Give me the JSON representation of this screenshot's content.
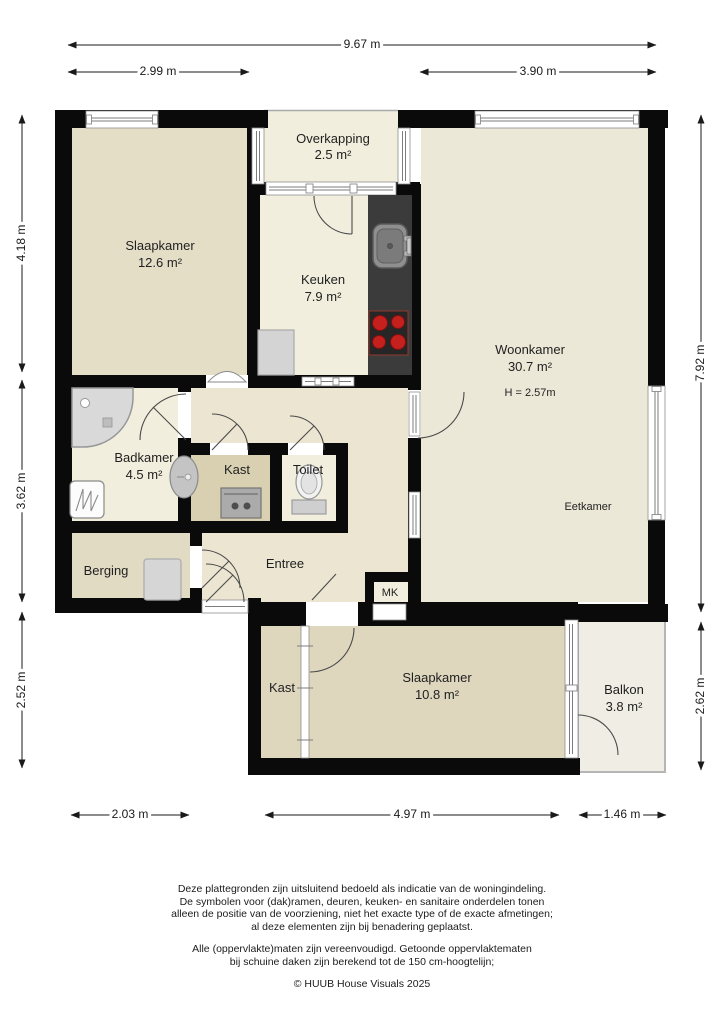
{
  "rooms": {
    "slaapkamer_tl": {
      "name": "Slaapkamer",
      "area": "12.6 m²"
    },
    "overkapping": {
      "name": "Overkapping",
      "area": "2.5 m²"
    },
    "keuken": {
      "name": "Keuken",
      "area": "7.9 m²"
    },
    "woonkamer": {
      "name": "Woonkamer",
      "area": "30.7 m²",
      "height": "H = 2.57m"
    },
    "eetkamer": {
      "name": "Eetkamer"
    },
    "badkamer": {
      "name": "Badkamer",
      "area": "4.5 m²"
    },
    "kast": {
      "name": "Kast"
    },
    "toilet": {
      "name": "Toilet"
    },
    "berging": {
      "name": "Berging"
    },
    "entree": {
      "name": "Entree"
    },
    "mk": {
      "name": "MK"
    },
    "kast_bottom": {
      "name": "Kast"
    },
    "slaapkamer_bottom": {
      "name": "Slaapkamer",
      "area": "10.8 m²"
    },
    "balkon": {
      "name": "Balkon",
      "area": "3.8 m²"
    }
  },
  "dimensions": {
    "top_total": "9.67 m",
    "top_left": "2.99 m",
    "top_right": "3.90 m",
    "left_top": "4.18 m",
    "left_middle": "3.62 m",
    "left_bottom": "2.52 m",
    "right_top": "7.92 m",
    "right_bottom": "2.62 m",
    "bottom_left": "2.03 m",
    "bottom_middle": "4.97 m",
    "bottom_right": "1.46 m"
  },
  "footer": {
    "disclaimer_lines": [
      "Deze plattegronden zijn uitsluitend bedoeld als indicatie van de woningindeling.",
      "De symbolen voor (dak)ramen, deuren, keuken- en sanitaire onderdelen tonen",
      "alleen de positie van de voorziening, niet het exacte type of de exacte afmetingen;",
      "al deze elementen zijn bij benadering geplaatst."
    ],
    "note_lines": [
      "Alle (oppervlakte)maten zijn vereenvoudigd. Getoonde oppervlaktematen",
      "bij schuine daken zijn berekend tot de 150 cm-hoogtelijn;"
    ],
    "copyright": "© HUUB House Visuals 2025"
  },
  "colors": {
    "wall": "#0a0a0a",
    "room_light": "#f1eedd",
    "room_mid": "#ece8d8",
    "room_tan_dark": "#ded7be",
    "room_tan": "#e4dec7",
    "kast_fill": "#d8d0b1",
    "counter": "#3b3b3b",
    "burner_red": "#c4201d",
    "fixture_gray": "#d6d6d6"
  }
}
